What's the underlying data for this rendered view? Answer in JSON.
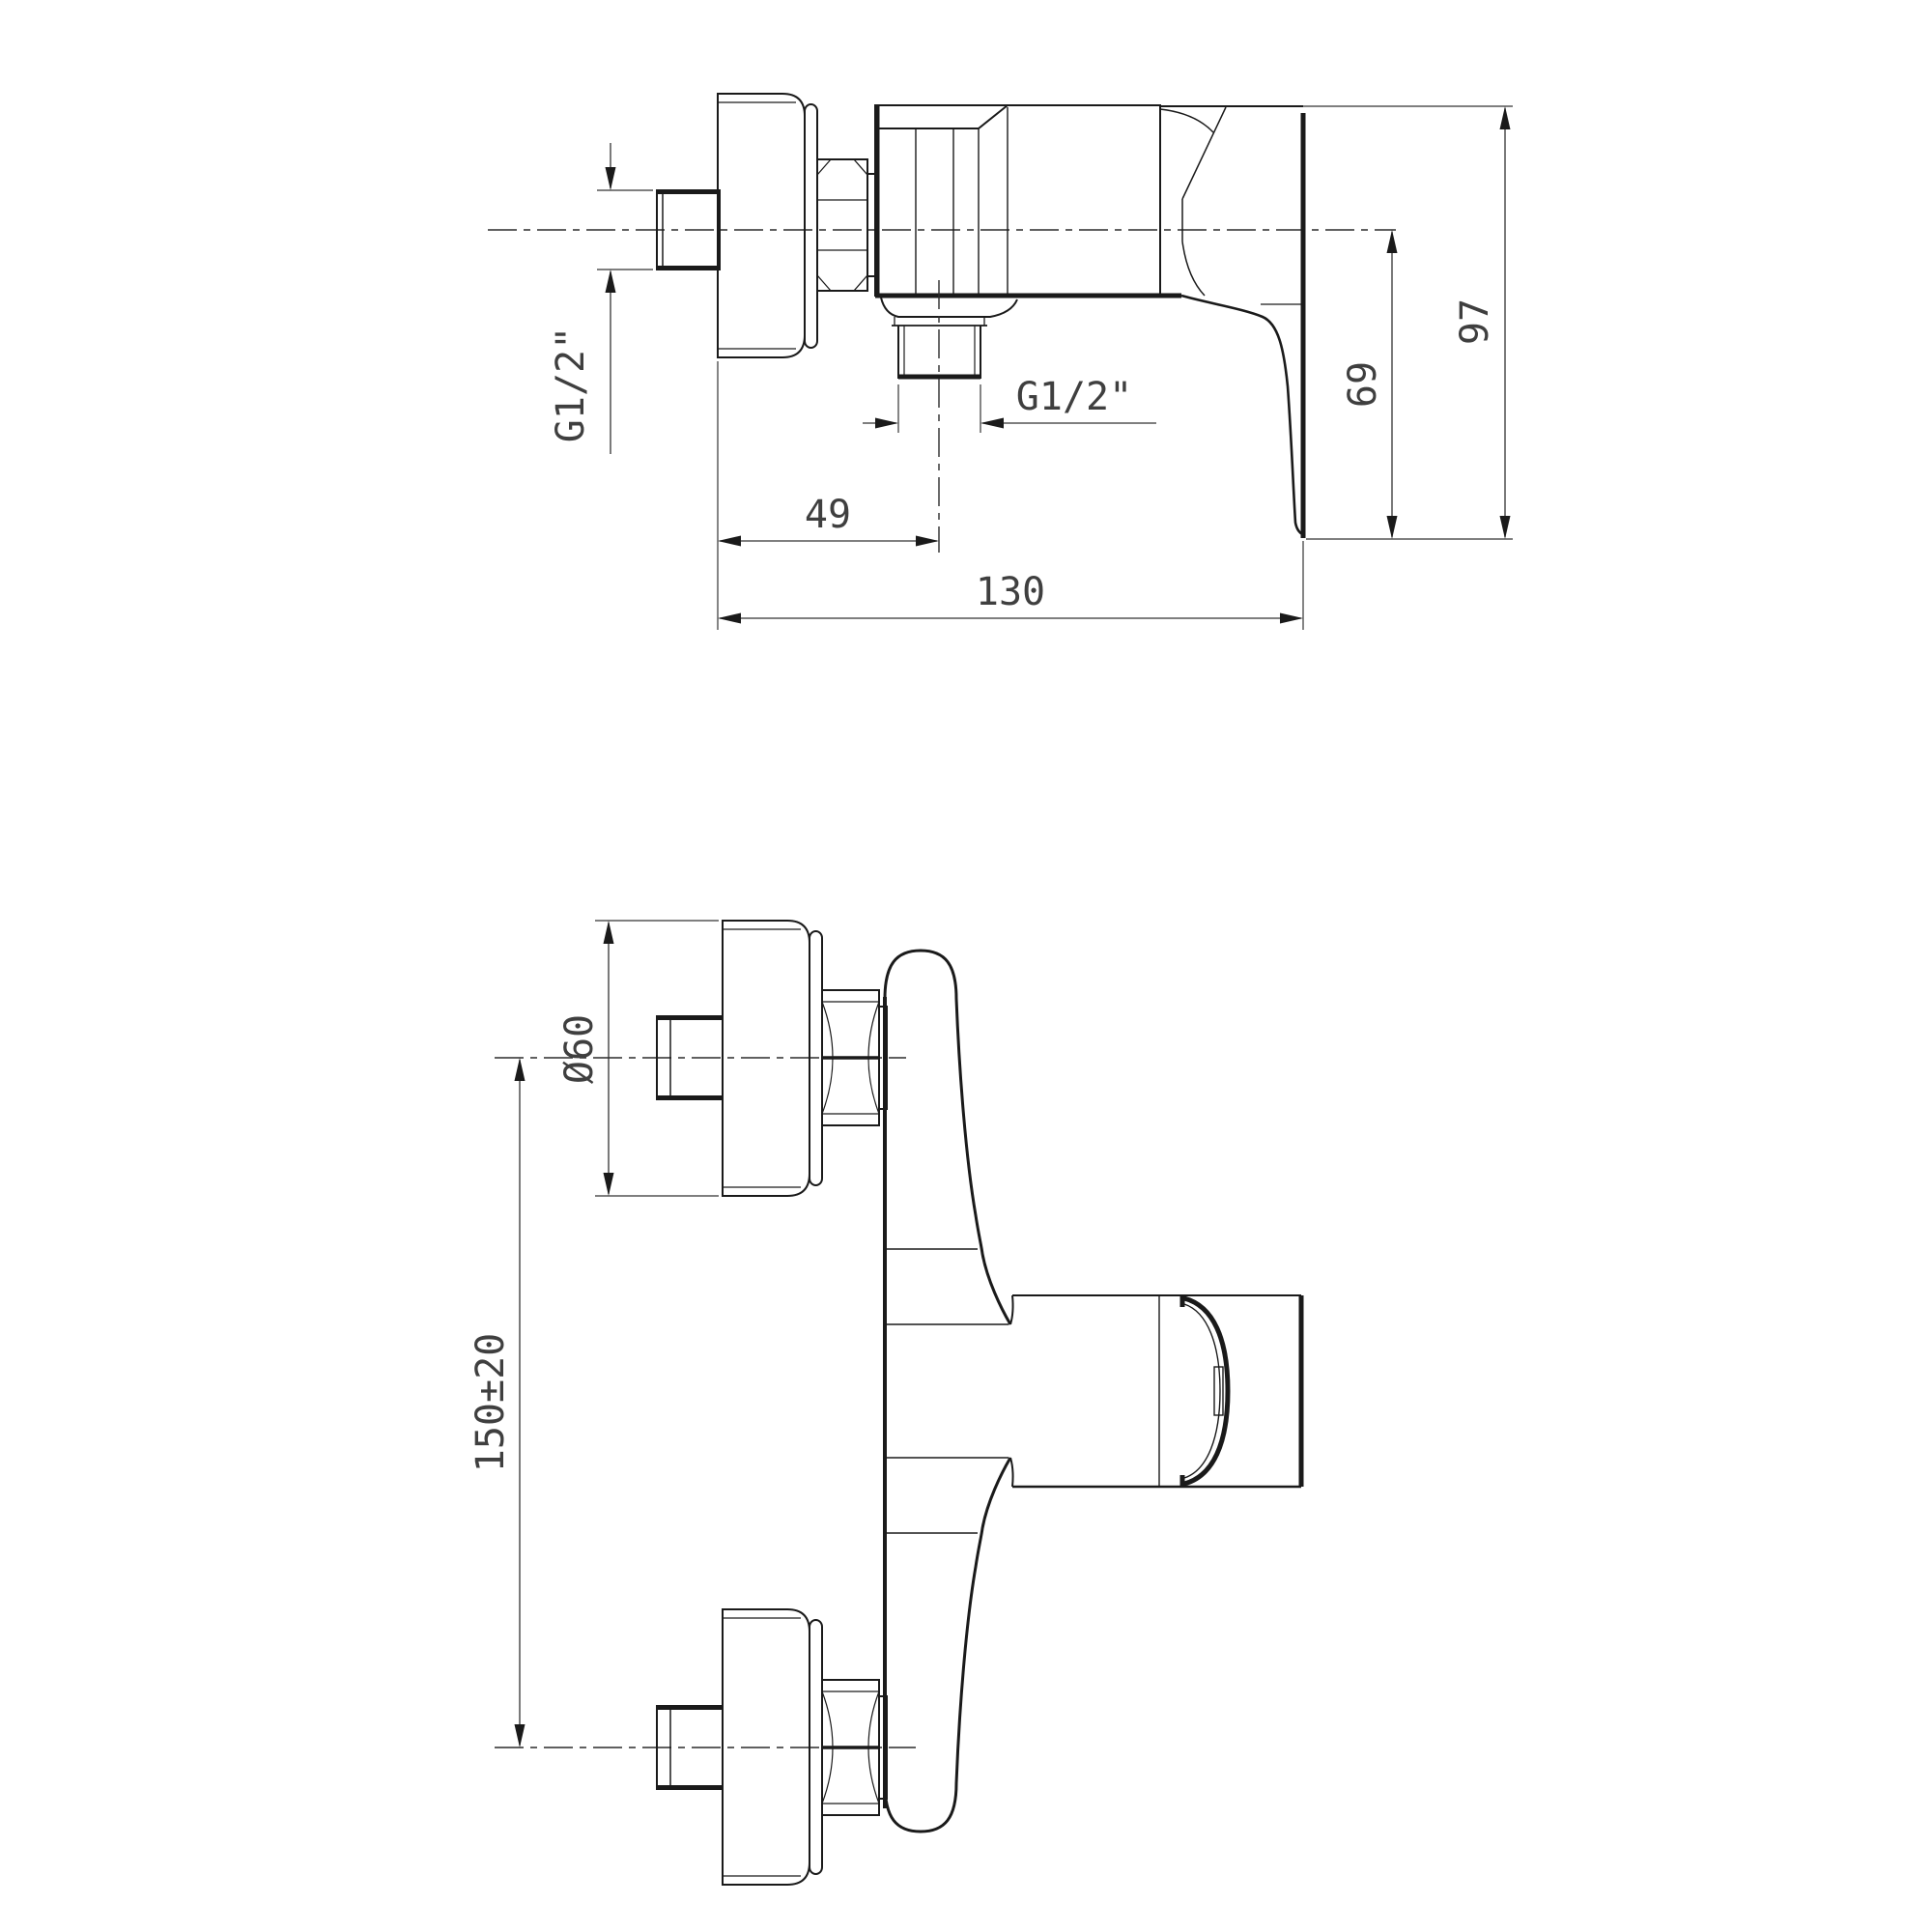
{
  "page": {
    "background": "#ffffff"
  },
  "drawing": {
    "kind": "technical-dimension-drawing",
    "subject": "wall-mounted single-lever shower mixer",
    "line_color": "#1a1a1a",
    "text_color": "#3f3f3f",
    "views": {
      "side": {
        "label": "side-view",
        "dims": {
          "inlet_thread": "G1/2\"",
          "outlet_thread": "G1/2\"",
          "outlet_offset": "49",
          "depth": "130",
          "lever_drop": "69",
          "height": "97"
        }
      },
      "front": {
        "label": "front-view",
        "dims": {
          "flange_diameter": "Ø60",
          "connection_spacing": "150±20"
        }
      }
    }
  }
}
